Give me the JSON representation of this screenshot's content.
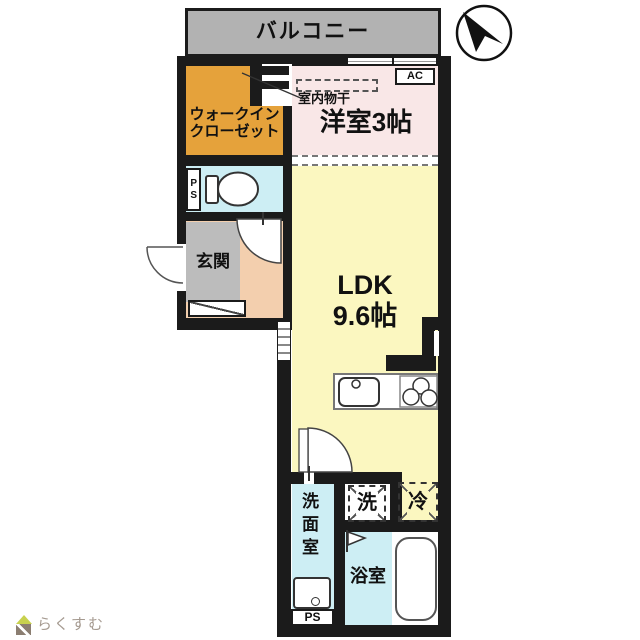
{
  "plan": {
    "balcony_label": "バルコニー",
    "closet_label_line1": "ウォークイン",
    "closet_label_line2": "クローゼット",
    "ac_label": "AC",
    "drying_label": "室内物干",
    "western_room_label": "洋室3帖",
    "ps_top_label": "PS",
    "entrance_label": "玄関",
    "ldk_label_line1": "LDK",
    "ldk_label_line2": "9.6帖",
    "washer_label": "洗",
    "fridge_label": "冷",
    "washroom_label": "洗面室",
    "bathroom_label": "浴室",
    "ps_bottom_label": "PS",
    "colors": {
      "wall": "#1b1b1b",
      "balcony": "#b2b2b2",
      "closet": "#e5a23b",
      "western_room": "#f9e7e7",
      "ldk": "#fbf7c0",
      "water_rooms": "#cdeef4",
      "hallway": "#f3cfae",
      "entrance": "#bcbcbc"
    }
  },
  "footer": {
    "logo_text": "らくすむ",
    "logo_colors": {
      "roof": "#c8d14e",
      "body": "#8b7e71",
      "text": "#a59a90"
    }
  }
}
